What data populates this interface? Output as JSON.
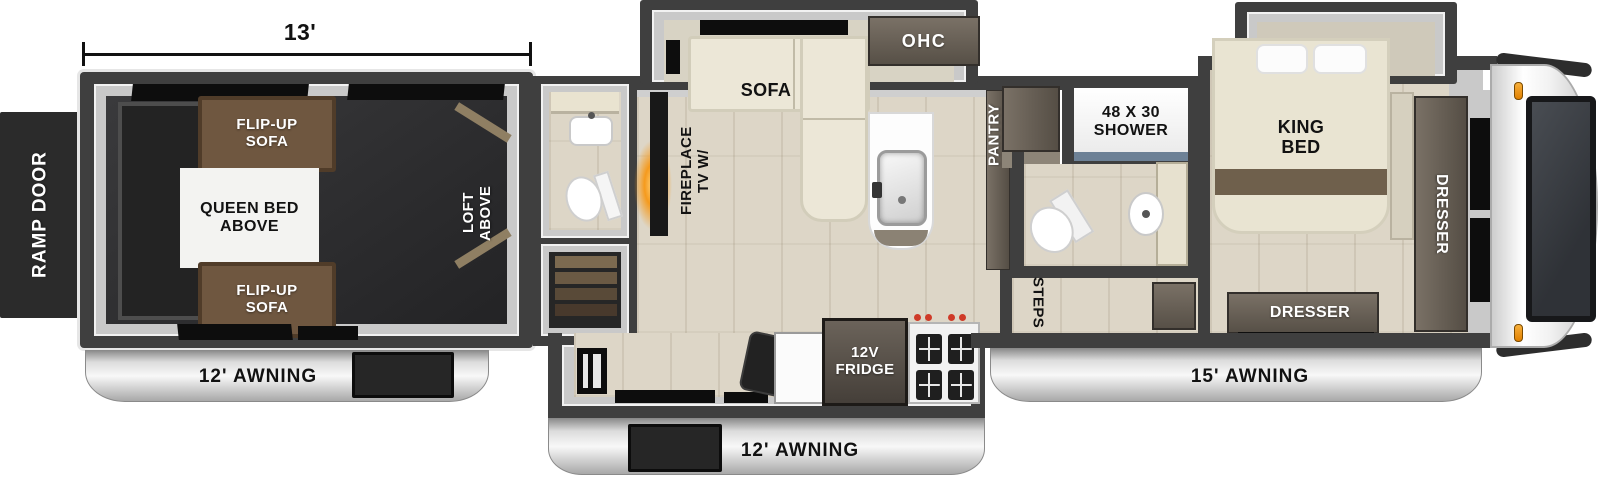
{
  "dimension": {
    "garage_length": "13'"
  },
  "exterior": {
    "ramp_door": "RAMP DOOR",
    "awning_rear": "12' AWNING",
    "awning_main": "12' AWNING",
    "awning_front": "15' AWNING"
  },
  "garage": {
    "flip_up_sofa_top": "FLIP-UP\nSOFA",
    "queen_bed_above": "QUEEN BED\nABOVE",
    "flip_up_sofa_bottom": "FLIP-UP\nSOFA",
    "loft_above": "LOFT\nABOVE"
  },
  "living": {
    "sofa": "SOFA",
    "ohc": "OHC",
    "tv_fireplace": "TV W/\nFIREPLACE"
  },
  "kitchen": {
    "pantry": "PANTRY",
    "fridge": "12V\nFRIDGE"
  },
  "bathroom": {
    "shower": "48 X 30\nSHOWER"
  },
  "bedroom": {
    "steps": "STEPS",
    "king_bed": "KING\nBED",
    "dresser_side": "DRESSER",
    "dresser_front": "DRESSER"
  },
  "colors": {
    "wall": "#3f3f3f",
    "floor_wood": "#ddd6c7",
    "garage_floor": "#2e2e2e",
    "sofa_brown": "#6f5740",
    "upholstery_cream": "#ece7d7",
    "cabinet_wood": "#6b6257",
    "awning_silver": "#d9d9d9",
    "fireplace_flame": "#f59a1d",
    "marker_light": "#f0921e",
    "shower_glass": "#6d8196"
  }
}
